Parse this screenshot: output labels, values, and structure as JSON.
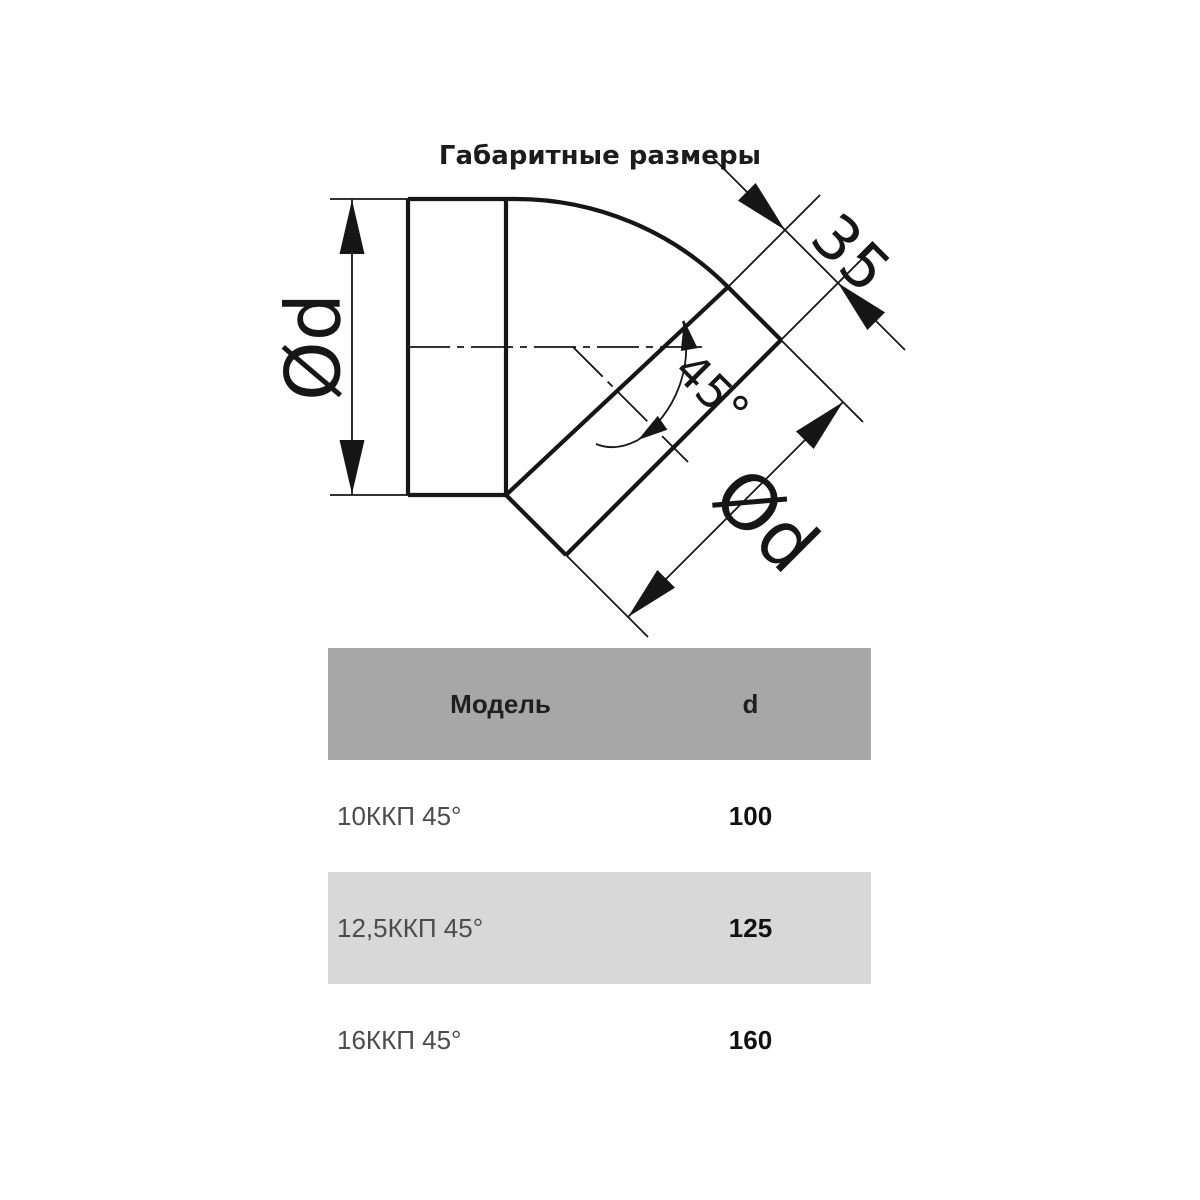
{
  "title": "Габаритные размеры",
  "drawing": {
    "inlet_diameter_label": "Ød",
    "outlet_diameter_label": "Ød",
    "collar_length_label": "35",
    "angle_label": "45°"
  },
  "table": {
    "header": {
      "model": "Модель",
      "d": "d"
    },
    "rows": [
      {
        "model": "10ККП 45°",
        "d": "100"
      },
      {
        "model": "12,5ККП 45°",
        "d": "125"
      },
      {
        "model": "16ККП 45°",
        "d": "160"
      }
    ]
  },
  "colors": {
    "line": "#161616",
    "table_header_bg": "#a7a7a7",
    "table_row_alt_bg": "#d8d8d8",
    "text_dark": "#1c1c1c",
    "text_muted": "#4c4c4c"
  }
}
